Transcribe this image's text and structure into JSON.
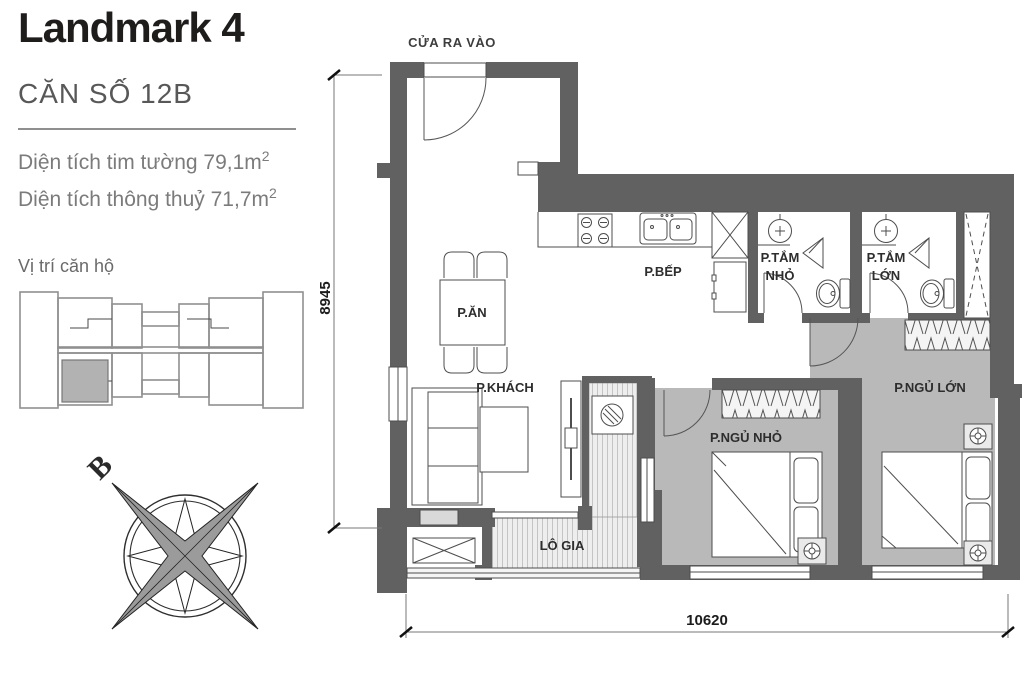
{
  "sidebar": {
    "title": "Landmark 4",
    "unit": "CĂN SỐ 12B",
    "area_line1": "Diện tích tim tường 79,1m",
    "area_line1_sup": "2",
    "area_line2": "Diện tích thông thuỷ 71,7m",
    "area_line2_sup": "2",
    "location_label": "Vị trí căn hộ"
  },
  "compass": {
    "north_letter": "B"
  },
  "plan": {
    "entrance_label": "CỬA RA VÀO",
    "rooms": {
      "dining": "P.ĂN",
      "kitchen": "P.BẾP",
      "living": "P.KHÁCH",
      "bath_small_line1": "P.TẮM",
      "bath_small_line2": "NHỎ",
      "bath_large_line1": "P.TẮM",
      "bath_large_line2": "LỚN",
      "bedroom_small": "P.NGỦ NHỎ",
      "bedroom_large": "P.NGỦ LỚN",
      "loggia": "LÔ GIA"
    },
    "dimensions": {
      "vertical": "8945",
      "horizontal": "10620"
    }
  },
  "colors": {
    "wall": "#616161",
    "floor_gray": "#b9b9b9",
    "unit_highlight": "#b2b2b2"
  }
}
